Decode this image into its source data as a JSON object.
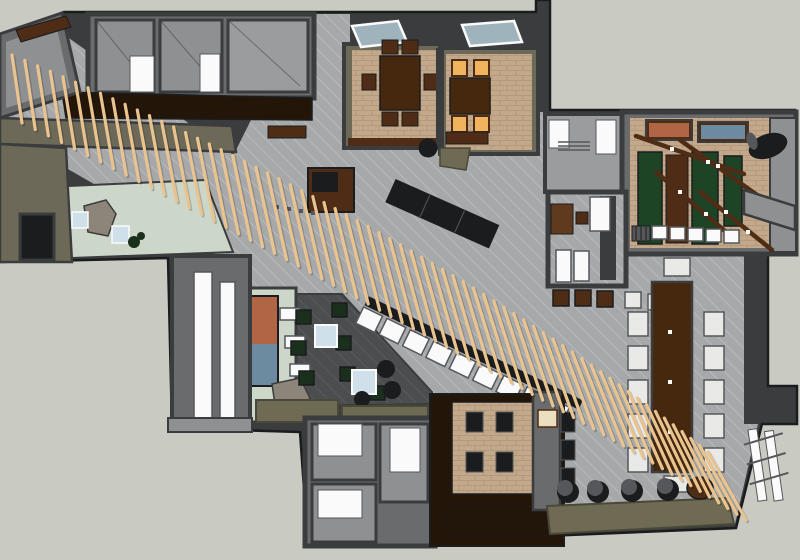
{
  "scene": {
    "type": "3d-floorplan-render",
    "description": "Overhead SketchUp-style cutaway rendering of a hospitality interior with a long diagonal timber-slat screen crossing the plan",
    "regions": [
      "top-utility-rooms",
      "dining-room-a",
      "dining-room-b",
      "pantry-room",
      "games-room",
      "office-lounge",
      "entry-vestibule",
      "mural-lounge",
      "central-hall",
      "bar-counter",
      "reception-desk",
      "communal-table",
      "treatment-rooms",
      "private-dining",
      "timber-slat-screen",
      "rear-terrace"
    ]
  },
  "palette": {
    "canvas": "#c9cbc3",
    "wall_dark": "#3b3c3e",
    "wall_mid": "#6a6b6d",
    "wall_light": "#8f9092",
    "room_light": "#9b9c9e",
    "wall_taupe": "#6d6959",
    "floor_gray": "#a6a8aa",
    "floor_line": "#b8babc",
    "charcoal": "#4b4d4f",
    "charcoal_line": "#585a5c",
    "brick": "#c3a98c",
    "brick_line": "#b29374",
    "wood_floor": "#241509",
    "walnut": "#4e2c15",
    "wood_med": "#5f3a1f",
    "wood_table": "#46280f",
    "green_felt": "#1d4425",
    "chair_green": "#1b2f1d",
    "green_floor": "#ccd7c9",
    "amber": "#f0b35e",
    "white": "#fafafa",
    "off_white": "#e9e9e7",
    "blue_seat": "#cfe0ea",
    "glass": "#9fb3bd",
    "cream": "#ecdfc0",
    "olive": "#6e6a53",
    "olive_dark": "#4a4838",
    "mural_orange": "#b06545",
    "mural_blue": "#6d8ba0",
    "rock": "#8d857a",
    "steel": "#55575a",
    "black": "#1b1c1e"
  },
  "slat_screen": {
    "count": 66,
    "p0": [
      12,
      55
    ],
    "p1": [
      430,
      230
    ],
    "p2": [
      708,
      452
    ],
    "lean_start": 10,
    "lean_end": 38,
    "len_base": 68,
    "len_amp": 22,
    "width": 3.2,
    "color": "#eac48f",
    "shadow": "#00000030"
  }
}
